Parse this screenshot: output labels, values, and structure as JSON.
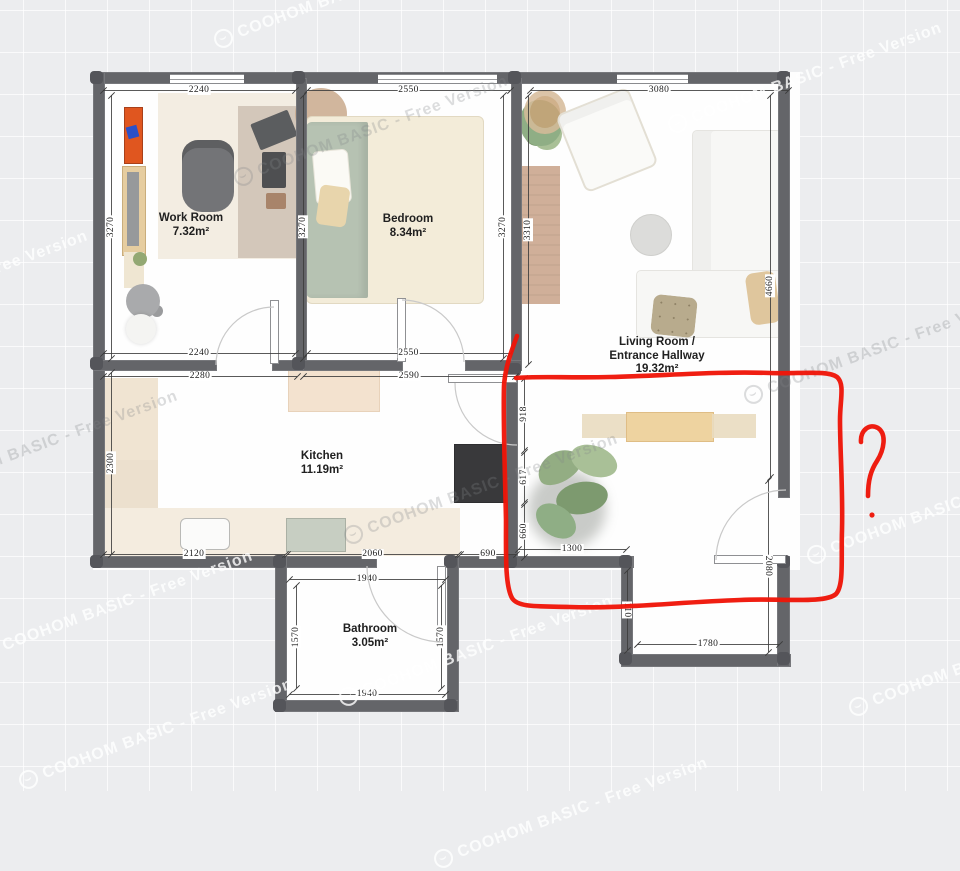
{
  "app": {
    "name": "floor-plan-editor",
    "watermark": {
      "text": "COOHOM BASIC - Free Version",
      "logo_icon": "coohom-badge-icon",
      "instances": [
        {
          "x": 351,
          "y": -8,
          "tone": "light"
        },
        {
          "x": 805,
          "y": 77,
          "tone": "light"
        },
        {
          "x": -49,
          "y": 285,
          "tone": "light"
        },
        {
          "x": 371,
          "y": 130,
          "tone": "dark"
        },
        {
          "x": 481,
          "y": 488,
          "tone": "dark"
        },
        {
          "x": 41,
          "y": 445,
          "tone": "dark"
        },
        {
          "x": 116,
          "y": 605,
          "tone": "light"
        },
        {
          "x": 476,
          "y": 650,
          "tone": "light"
        },
        {
          "x": 156,
          "y": 733,
          "tone": "light"
        },
        {
          "x": 986,
          "y": 660,
          "tone": "light"
        },
        {
          "x": 571,
          "y": 812,
          "tone": "light"
        },
        {
          "x": 944,
          "y": 508,
          "tone": "light"
        },
        {
          "x": 881,
          "y": 348,
          "tone": "dark"
        }
      ]
    }
  },
  "rooms": [
    {
      "id": "work-room",
      "name": "Work Room",
      "area": "7.32m²",
      "x": 191,
      "y": 212
    },
    {
      "id": "bedroom",
      "name": "Bedroom",
      "area": "8.34m²",
      "x": 408,
      "y": 213
    },
    {
      "id": "living-room",
      "name": "Living Room /",
      "name2": "Entrance Hallway",
      "area": "19.32m²",
      "x": 657,
      "y": 336
    },
    {
      "id": "kitchen",
      "name": "Kitchen",
      "area": "11.19m²",
      "x": 322,
      "y": 450
    },
    {
      "id": "bathroom",
      "name": "Bathroom",
      "area": "3.05m²",
      "x": 370,
      "y": 623
    }
  ],
  "dimensions": [
    {
      "label": "2240",
      "x1": 103,
      "y1": 90,
      "x2": 295,
      "y2": 90
    },
    {
      "label": "2550",
      "x1": 307,
      "y1": 90,
      "x2": 510,
      "y2": 90
    },
    {
      "label": "3080",
      "x1": 530,
      "y1": 90,
      "x2": 788,
      "y2": 90
    },
    {
      "label": "3270",
      "x1": 111,
      "y1": 95,
      "x2": 111,
      "y2": 358,
      "rot": "ccw"
    },
    {
      "label": "2300",
      "x1": 111,
      "y1": 372,
      "x2": 111,
      "y2": 554,
      "rot": "ccw"
    },
    {
      "label": "3270",
      "x1": 303,
      "y1": 95,
      "x2": 303,
      "y2": 358,
      "rot": "ccw"
    },
    {
      "label": "3270",
      "x1": 503,
      "y1": 95,
      "x2": 503,
      "y2": 358,
      "rot": "ccw"
    },
    {
      "label": "3310",
      "x1": 528,
      "y1": 95,
      "x2": 528,
      "y2": 364,
      "rot": "ccw"
    },
    {
      "label": "4660",
      "x1": 770,
      "y1": 95,
      "x2": 770,
      "y2": 477,
      "rot": "ccw"
    },
    {
      "label": "2240",
      "x1": 103,
      "y1": 353,
      "x2": 295,
      "y2": 353
    },
    {
      "label": "2550",
      "x1": 307,
      "y1": 353,
      "x2": 510,
      "y2": 353
    },
    {
      "label": "2280",
      "x1": 103,
      "y1": 376,
      "x2": 297,
      "y2": 376
    },
    {
      "label": "2590",
      "x1": 303,
      "y1": 376,
      "x2": 515,
      "y2": 376
    },
    {
      "label": "918",
      "x1": 524,
      "y1": 378,
      "x2": 524,
      "y2": 450,
      "rot": "ccw"
    },
    {
      "label": "617",
      "x1": 524,
      "y1": 452,
      "x2": 524,
      "y2": 502,
      "rot": "ccw"
    },
    {
      "label": "660",
      "x1": 524,
      "y1": 504,
      "x2": 524,
      "y2": 557,
      "rot": "ccw"
    },
    {
      "label": "2120",
      "x1": 103,
      "y1": 554,
      "x2": 285,
      "y2": 554
    },
    {
      "label": "2060",
      "x1": 287,
      "y1": 554,
      "x2": 458,
      "y2": 554
    },
    {
      "label": "690",
      "x1": 460,
      "y1": 554,
      "x2": 516,
      "y2": 554
    },
    {
      "label": "1300",
      "x1": 518,
      "y1": 549,
      "x2": 626,
      "y2": 549
    },
    {
      "label": "1940",
      "x1": 289,
      "y1": 579,
      "x2": 445,
      "y2": 579
    },
    {
      "label": "1940",
      "x1": 289,
      "y1": 694,
      "x2": 445,
      "y2": 694
    },
    {
      "label": "1570",
      "x1": 296,
      "y1": 585,
      "x2": 296,
      "y2": 688,
      "rot": "ccw"
    },
    {
      "label": "1570",
      "x1": 441,
      "y1": 585,
      "x2": 441,
      "y2": 688,
      "rot": "ccw"
    },
    {
      "label": "110",
      "x1": 627,
      "y1": 570,
      "x2": 627,
      "y2": 650,
      "rot": "cw"
    },
    {
      "label": "1780",
      "x1": 637,
      "y1": 644,
      "x2": 779,
      "y2": 644
    },
    {
      "label": "2080",
      "x1": 768,
      "y1": 480,
      "x2": 768,
      "y2": 652,
      "rot": "cw"
    }
  ],
  "annotation": {
    "type": "freehand-pen",
    "color": "#ef1508",
    "stroke_width": 4.6,
    "shapes": [
      "enclosure-loop",
      "question-mark",
      "question-mark-dot"
    ],
    "paths": {
      "loop": "M517,336 C511,352 505,368 504,386 C503,420 505,470 506,520 C506,555 505,585 512,598 C518,608 540,606 570,607 C620,609 680,602 740,600 C780,598 825,604 836,594 C844,585 841,560 842,530 C843,490 840,450 840,420 C840,400 845,384 837,377 C828,370 800,374 770,373 C720,371 660,376 610,377 C570,378 535,376 516,378",
      "qmark": "M861,442 C860,430 870,423 878,428 C887,434 884,450 877,461 C871,470 868,480 868,496"
    },
    "dot": {
      "x": 872,
      "y": 515,
      "r": 2.6
    }
  }
}
